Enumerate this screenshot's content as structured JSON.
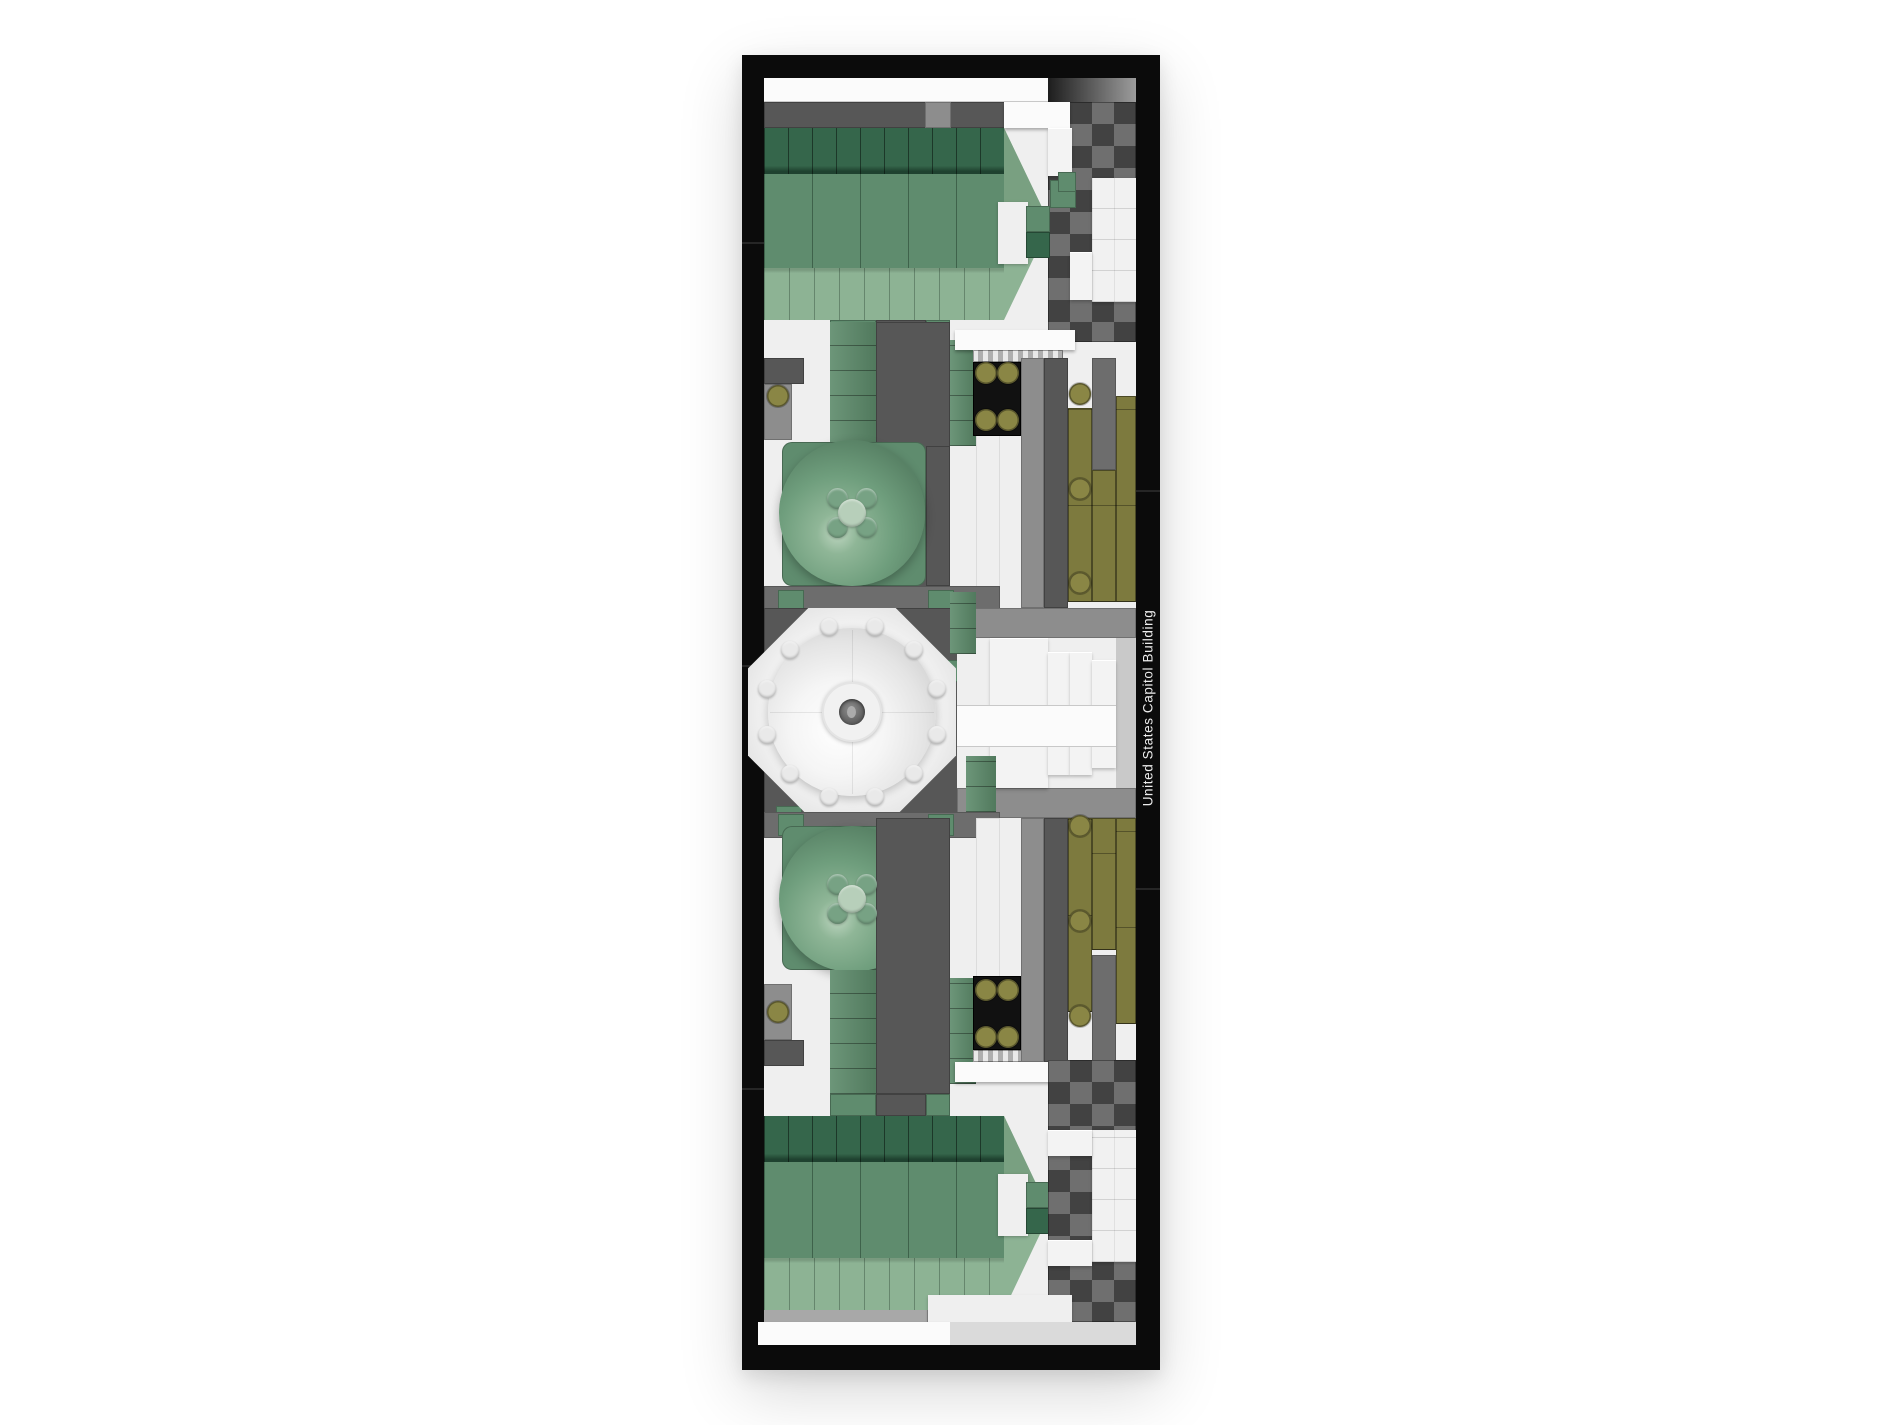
{
  "plaque": {
    "label": "United States Capitol Building"
  },
  "palette": {
    "frame": "#0b0b0b",
    "black-tile": "#111111",
    "white-a": "#efefef",
    "white-b": "#fbfbfb",
    "white-c": "#dedede",
    "gray-1": "#c9c9c9",
    "gray-2": "#a8a8a8",
    "gray-3": "#8d8d8d",
    "gray-4": "#6d6d6d",
    "gray-5": "#575757",
    "gray-6": "#3d3d3d",
    "green-flat": "#5f8c6e",
    "green-light": "#8db394",
    "green-mid": "#79a081",
    "green-dark": "#35664b",
    "green-shadow": "#1f4230",
    "green-tile": "#5c8a6a",
    "olive": "#7d7a3e",
    "olive-hi": "#8a8645",
    "olive-dark": "#63602f"
  },
  "decals": {
    "olive_circles": [
      {
        "x": 778,
        "y": 396
      },
      {
        "x": 778,
        "y": 1012
      },
      {
        "x": 986,
        "y": 373
      },
      {
        "x": 1008,
        "y": 373
      },
      {
        "x": 986,
        "y": 420
      },
      {
        "x": 1008,
        "y": 420
      },
      {
        "x": 986,
        "y": 990
      },
      {
        "x": 1008,
        "y": 990
      },
      {
        "x": 986,
        "y": 1037
      },
      {
        "x": 1008,
        "y": 1037
      },
      {
        "x": 1080,
        "y": 394
      },
      {
        "x": 1080,
        "y": 489
      },
      {
        "x": 1080,
        "y": 583
      },
      {
        "x": 1080,
        "y": 826
      },
      {
        "x": 1080,
        "y": 921
      },
      {
        "x": 1080,
        "y": 1016
      }
    ],
    "stud_rings": [
      {
        "cx": 852,
        "cy": 712,
        "r": 88,
        "n": 12,
        "start": 15,
        "size": 18,
        "fill": "#e9e9e9"
      },
      {
        "cx": 852,
        "cy": 513,
        "r": 21,
        "n": 4,
        "start": 45,
        "size": 21,
        "fill": "#77a284"
      },
      {
        "cx": 852,
        "cy": 899,
        "r": 21,
        "n": 4,
        "start": 45,
        "size": 21,
        "fill": "#77a284"
      }
    ],
    "center_studs": [
      {
        "cx": 852,
        "cy": 513,
        "r": 14,
        "fill": "#b7cfba"
      },
      {
        "cx": 852,
        "cy": 899,
        "r": 14,
        "fill": "#b7cfba"
      }
    ]
  }
}
